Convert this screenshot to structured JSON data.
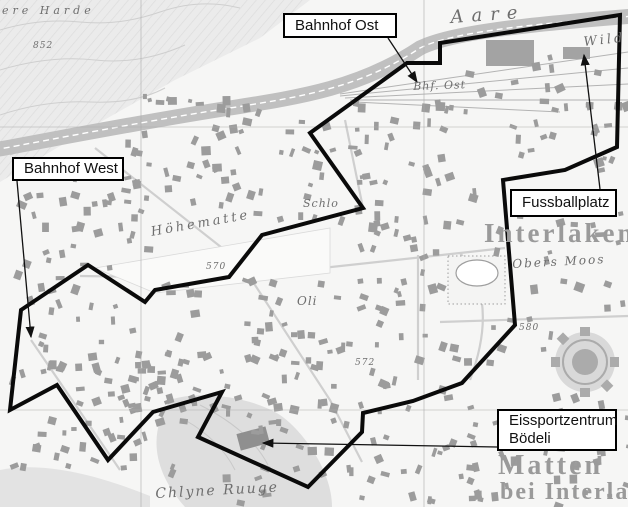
{
  "figure": {
    "kind": "annotated-topographic-map",
    "place": "Interlaken"
  },
  "colors": {
    "boundary": "#0a0a0a",
    "arrow": "#111111",
    "callout_bg": "#ffffff",
    "callout_border": "#000000",
    "town_label": "#9a9a9a",
    "detail_label": "#6e6e6e",
    "grid_line": "#ababab",
    "river": "#c0c0c0",
    "hill_fill": "#ebebeb",
    "building": "#9c9c9c"
  },
  "callouts": [
    {
      "id": "bahnhof-ost",
      "label": "Bahnhof Ost",
      "label2": "",
      "box": {
        "x": 283,
        "y": 13,
        "w": 114,
        "h": 25
      },
      "arrow": {
        "x1": 388,
        "y1": 38,
        "x2": 417,
        "y2": 82
      }
    },
    {
      "id": "bahnhof-west",
      "label": "Bahnhof West",
      "label2": "",
      "box": {
        "x": 12,
        "y": 157,
        "w": 112,
        "h": 24
      },
      "arrow": {
        "x1": 17,
        "y1": 181,
        "x2": 31,
        "y2": 337
      }
    },
    {
      "id": "fussballplatz",
      "label": "Fussballplatz",
      "label2": "",
      "box": {
        "x": 510,
        "y": 189,
        "w": 107,
        "h": 28
      },
      "arrow": {
        "x1": 600,
        "y1": 189,
        "x2": 584,
        "y2": 55
      }
    },
    {
      "id": "eissportzentrum",
      "label": "Eissportzentrum",
      "label2": "Bödeli",
      "box": {
        "x": 497,
        "y": 409,
        "w": 120,
        "h": 42
      },
      "arrow": {
        "x1": 497,
        "y1": 447,
        "x2": 263,
        "y2": 443
      }
    }
  ],
  "map_labels": [
    {
      "text": "ere Harde",
      "x": 2,
      "y": 5,
      "size": 11,
      "ls": 4,
      "rot": 0,
      "cls": "italic"
    },
    {
      "text": "852",
      "x": 33,
      "y": 42,
      "size": 9,
      "ls": 1,
      "rot": 0,
      "cls": "italic"
    },
    {
      "text": "Aare",
      "x": 450,
      "y": 9,
      "size": 18,
      "ls": 8,
      "rot": -4,
      "cls": "italic"
    },
    {
      "text": "Wild",
      "x": 583,
      "y": 36,
      "size": 13,
      "ls": 3,
      "rot": -6,
      "cls": "italic"
    },
    {
      "text": "Bhf. Ost",
      "x": 413,
      "y": 81,
      "size": 11,
      "ls": 1,
      "rot": -2,
      "cls": "italic"
    },
    {
      "text": "Höhematte",
      "x": 150,
      "y": 226,
      "size": 13,
      "ls": 3,
      "rot": -10,
      "cls": "italic"
    },
    {
      "text": "570",
      "x": 206,
      "y": 263,
      "size": 9,
      "ls": 1,
      "rot": 0,
      "cls": "italic"
    },
    {
      "text": "Schlo",
      "x": 303,
      "y": 198,
      "size": 11,
      "ls": 1,
      "rot": 0,
      "cls": "italic"
    },
    {
      "text": "Oli",
      "x": 297,
      "y": 295,
      "size": 12,
      "ls": 1,
      "rot": 0,
      "cls": "italic"
    },
    {
      "text": "572",
      "x": 355,
      "y": 359,
      "size": 9,
      "ls": 1,
      "rot": 0,
      "cls": "italic"
    },
    {
      "text": "Obers Moos",
      "x": 512,
      "y": 258,
      "size": 12,
      "ls": 2,
      "rot": -3,
      "cls": "italic"
    },
    {
      "text": "580",
      "x": 519,
      "y": 324,
      "size": 9,
      "ls": 1,
      "rot": 0,
      "cls": "italic"
    },
    {
      "text": "Interlaken",
      "x": 484,
      "y": 220,
      "size": 27,
      "ls": 3,
      "rot": 0,
      "cls": "town"
    },
    {
      "text": "Matten",
      "x": 498,
      "y": 452,
      "size": 28,
      "ls": 3,
      "rot": 0,
      "cls": "town"
    },
    {
      "text": "bei Interlaken",
      "x": 500,
      "y": 480,
      "size": 24,
      "ls": 2,
      "rot": 0,
      "cls": "town"
    },
    {
      "text": "Chlyne Ruuge",
      "x": 155,
      "y": 487,
      "size": 14,
      "ls": 2,
      "rot": -3,
      "cls": "italic"
    }
  ],
  "boundary": {
    "stroke_width": 4,
    "points": [
      [
        620,
        15
      ],
      [
        617,
        147
      ],
      [
        565,
        170
      ],
      [
        503,
        180
      ],
      [
        515,
        325
      ],
      [
        462,
        383
      ],
      [
        413,
        401
      ],
      [
        363,
        413
      ],
      [
        362,
        432
      ],
      [
        308,
        487
      ],
      [
        198,
        437
      ],
      [
        222,
        392
      ],
      [
        153,
        412
      ],
      [
        108,
        460
      ],
      [
        57,
        385
      ],
      [
        10,
        410
      ],
      [
        21,
        310
      ],
      [
        88,
        265
      ],
      [
        145,
        302
      ],
      [
        155,
        290
      ],
      [
        229,
        277
      ],
      [
        262,
        235
      ],
      [
        363,
        208
      ],
      [
        310,
        133
      ],
      [
        407,
        63
      ],
      [
        440,
        63
      ],
      [
        440,
        43
      ]
    ]
  },
  "grid": {
    "vertical_x": [
      141,
      424
    ],
    "horizontal_y": [
      127,
      410
    ]
  },
  "base_map": {
    "river_path": "M -6 150 C 60 138 140 122 230 108 C 300 97 360 88 420 48 C 450 33 520 25 634 16",
    "building_clusters": [
      [
        15,
        170,
        130,
        135,
        38
      ],
      [
        35,
        300,
        150,
        120,
        44
      ],
      [
        150,
        272,
        185,
        135,
        55
      ],
      [
        115,
        128,
        215,
        95,
        42
      ],
      [
        335,
        175,
        165,
        210,
        68
      ],
      [
        130,
        92,
        205,
        42,
        20
      ],
      [
        215,
        392,
        255,
        108,
        52
      ],
      [
        0,
        355,
        195,
        120,
        40
      ],
      [
        497,
        195,
        130,
        125,
        26
      ],
      [
        468,
        412,
        160,
        92,
        32
      ],
      [
        438,
        52,
        190,
        58,
        18
      ],
      [
        345,
        95,
        115,
        82,
        24
      ],
      [
        528,
        328,
        100,
        82,
        14
      ],
      [
        505,
        98,
        123,
        72,
        16
      ]
    ],
    "exclusions": [
      [
        148,
        220,
        190,
        56
      ],
      [
        446,
        253,
        62,
        54
      ],
      [
        552,
        333,
        80,
        62
      ]
    ]
  }
}
